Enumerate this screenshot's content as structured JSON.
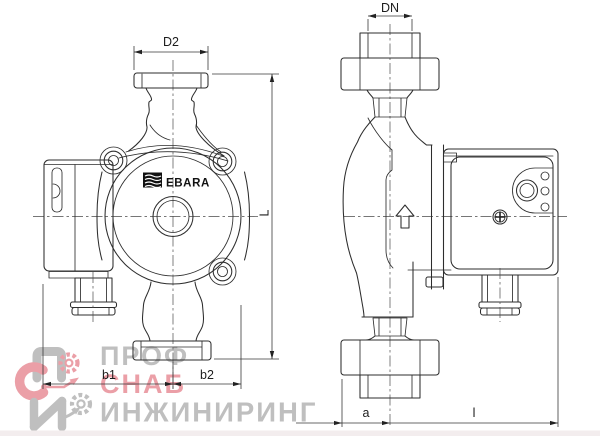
{
  "drawing": {
    "brand_label": "EBARA",
    "dims": {
      "d2": "D2",
      "dn": "DN",
      "length": "L",
      "b1": "b1",
      "b2": "b2",
      "a": "a",
      "l": "l"
    }
  },
  "watermark": {
    "line1": "ПРОФ",
    "line2": "СНАБ",
    "line3": "ИНЖИНИРИНГ"
  },
  "colors": {
    "line": "#2d2d2d",
    "watermark_gray": "#b9b9b9",
    "watermark_red": "#e9959e"
  }
}
